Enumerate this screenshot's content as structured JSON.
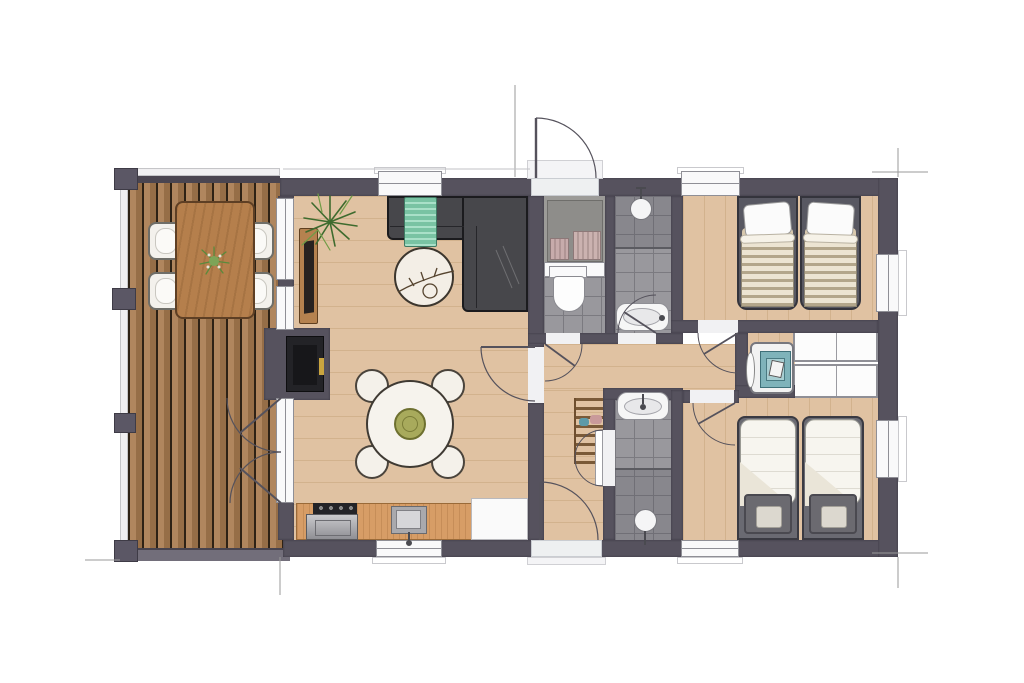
{
  "meta": {
    "type": "architectural-floor-plan",
    "view": "top-down-rendered",
    "window_count": 8,
    "door_count": 9
  },
  "palette": {
    "wall": "#56525E",
    "deckPlank": "#a97c50",
    "deckGap": "#2e2215",
    "deckFascia": "#726e7a",
    "rail": "#f0eff1",
    "floorWood": "#e0c2a2",
    "kitchenWood": "#d79d66",
    "tile": "#99989d",
    "tileLine": "#7b7a80",
    "fixture": "#f9f9fa",
    "fixtureLine": "#8f8f96",
    "sofa": "#47474b",
    "sofaLine": "#26262a",
    "throwGreen": "#79c3a3",
    "plantGreen": "#5d8f3c",
    "plantDark": "#3e6b2e",
    "outdoorTableWood": "#b57f4c",
    "chairWhite": "#f3f1ec",
    "oliveBowl": "#a8aa5c",
    "towelPink": "#c3a7a7",
    "applianceTeal": "#7fb3ba",
    "entranceFloor": "#9c9b98",
    "closetGray": "#8e8d8a",
    "bedFrame": "#585862",
    "duvet": "#f7f5ef",
    "pillowDark": "#6b6a70",
    "cabinet": "#fcfcfc",
    "stoveBlack": "#232327",
    "accentYellow": "#caa53f",
    "outline": "#55525c",
    "dimLine": "#9a9a9a"
  },
  "rooms": [
    {
      "name": "terrace-deck",
      "objects": [
        "outdoor-dining-table",
        "outdoor-chair-x4",
        "table-plant",
        "railing",
        "deck-posts",
        "french-doors-to-living-room"
      ]
    },
    {
      "name": "living-room",
      "objects": [
        "corner-sofa",
        "throw-blanket",
        "round-coffee-table",
        "decor-branch",
        "potted-plant",
        "tv-sideboard",
        "wood-stove"
      ]
    },
    {
      "name": "dining-area",
      "objects": [
        "round-dining-table",
        "dining-chair-x4",
        "serving-bowl"
      ]
    },
    {
      "name": "kitchen",
      "objects": [
        "countertop",
        "cooktop",
        "oven",
        "sink",
        "tall-white-cabinet",
        "window"
      ]
    },
    {
      "name": "entrance-hall",
      "objects": [
        "entrance-door",
        "hall-closet",
        "folded-towels"
      ]
    },
    {
      "name": "toilet-room",
      "objects": [
        "toilet",
        "cistern-shelf",
        "tiled-floor"
      ]
    },
    {
      "name": "bathroom-1",
      "objects": [
        "shower-head",
        "glass-divider",
        "washbasin",
        "tiled-floor"
      ]
    },
    {
      "name": "hallway",
      "objects": [
        "coat-rack",
        "back-door"
      ]
    },
    {
      "name": "bathroom-2",
      "objects": [
        "washbasin",
        "shower-head",
        "glass-divider",
        "tiled-floor"
      ]
    },
    {
      "name": "bedroom-1",
      "objects": [
        "single-bed-x2",
        "white-pillows",
        "striped-blankets",
        "window-x2"
      ]
    },
    {
      "name": "laundry-storage",
      "objects": [
        "washing-machine",
        "wardrobe-cabinet-x4"
      ]
    },
    {
      "name": "bedroom-2",
      "objects": [
        "single-bed-x2",
        "white-duvets",
        "dark-pillows",
        "window-x2"
      ]
    }
  ]
}
